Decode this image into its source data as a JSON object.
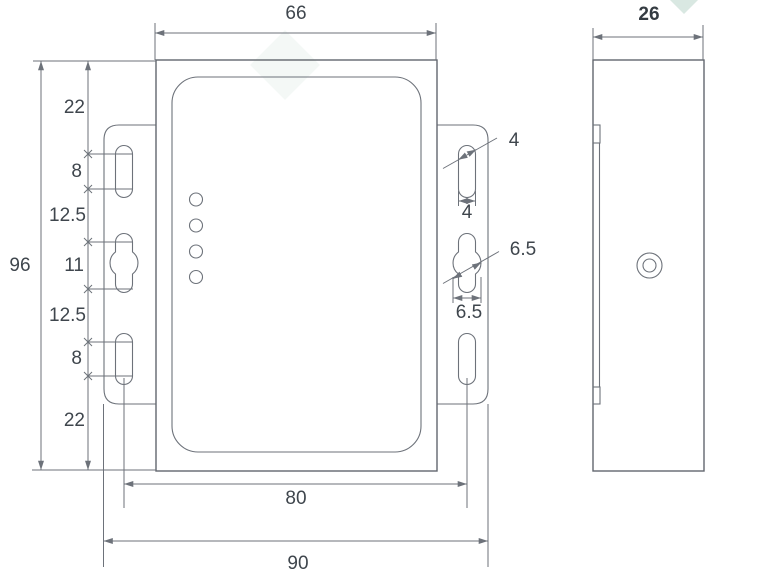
{
  "drawing": {
    "type": "technical-dimension-drawing",
    "views": {
      "front": "front view with mounting flanges",
      "side": "side view"
    },
    "front_view": {
      "led_count": 4,
      "mount_slot_count": 6
    },
    "labels": {
      "width_top": "66",
      "depth_top": "26",
      "height_overall": "96",
      "seg_22_top": "22",
      "seg_8_top": "8",
      "seg_12_5_upper": "12.5",
      "seg_11": "11",
      "seg_12_5_lower": "12.5",
      "seg_8_bottom": "8",
      "seg_22_bottom": "22",
      "slot_width_leader": "4",
      "slot_width_dim": "4",
      "bulge_dia_leader": "6.5",
      "bulge_dia_dim": "6.5",
      "slot_center_span": "80",
      "flange_overall_span": "90"
    },
    "colors": {
      "line": "#6d727a",
      "outline": "#62676e",
      "text": "#3f464d",
      "watermark": "#d9e8e2"
    }
  }
}
